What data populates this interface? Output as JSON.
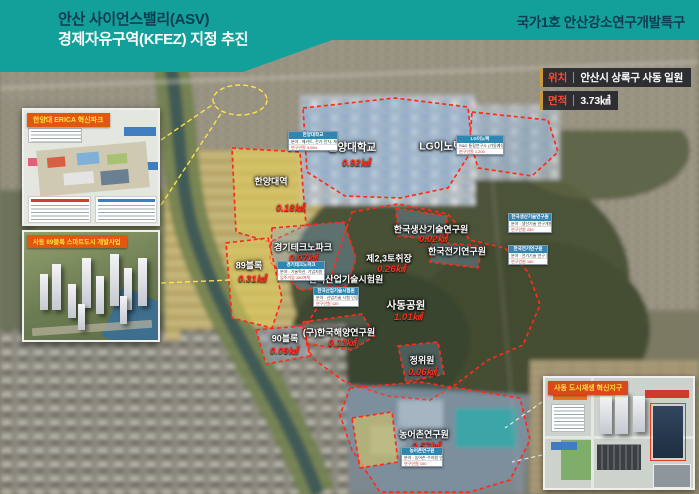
{
  "header": {
    "title_line1": "안산 사이언스밸리(ASV)",
    "title_line2": "경제자유구역(KFEZ) 지정 추진",
    "right_title": "국가1호 안산강소연구개발특구"
  },
  "info_box": {
    "rows": [
      {
        "label": "위치",
        "value": "안산시 상록구 사동 일원"
      },
      {
        "label": "면적",
        "value": "3.73㎢"
      }
    ]
  },
  "insets": [
    {
      "label": "한양대 ERICA 혁신파크"
    },
    {
      "label": "사동 89블록 스마트도시 개발사업"
    },
    {
      "label": "사동 도시재생 혁신지구"
    }
  ],
  "map": {
    "zones": [
      {
        "label": "한양대역",
        "area": "0.18㎢"
      },
      {
        "label": "한양대학교",
        "area": "0.92㎢"
      },
      {
        "label": "LG이노텍",
        "area": null
      },
      {
        "label": "경기테크노파크",
        "area": "0.07㎢"
      },
      {
        "label": "89블록",
        "area": "0.31㎢"
      },
      {
        "label": "한국산업기술시험원",
        "area": null
      },
      {
        "label": "제2,3토취장",
        "area": "0.26㎢"
      },
      {
        "label": "한국생산기술연구원",
        "area": "0.02㎢"
      },
      {
        "label": "한국전기연구원",
        "area": null
      },
      {
        "label": "사동공원",
        "area": "1.01㎢"
      },
      {
        "label": "(구)한국해양연구원",
        "area": "0.11㎢"
      },
      {
        "label": "정위원",
        "area": "0.06㎢"
      },
      {
        "label": "90블록",
        "area": "0.09㎢"
      },
      {
        "label": "농어촌연구원",
        "area": "0.57㎢"
      }
    ],
    "callouts": [
      {
        "title": "한양대학교",
        "line1": "분야 : 메카트, 전기·전자, 재료 등",
        "line2": "연구인원 3,084"
      },
      {
        "title": "LG이노텍",
        "line1": "R&D 통합연구소 (가동예정)",
        "line2": "연구인원 1,200"
      },
      {
        "title": "경기테크노파크",
        "line1": "분야 : 기술혁신, 기업지원 등",
        "line2": "입주기업 150여개"
      },
      {
        "title": "한국산업기술시험원",
        "line1": "분야 : 산업기술 시험·인증",
        "line2": "연구인원 120"
      },
      {
        "title": "한국생산기술연구원",
        "line1": "분야 : 생산기술 연구개발 등",
        "line2": "연구인원 230"
      },
      {
        "title": "한국전기연구원",
        "line1": "분야 : 전기기술 연구 등",
        "line2": "연구인원 150"
      },
      {
        "title": "농어촌연구원",
        "line1": "분야 : 농어촌·수자원 연구",
        "line2": "연구인원 100"
      }
    ]
  },
  "colors": {
    "header_bg": "#13a09b",
    "header_title_dark": "#0e3a52",
    "boundary_red": "#ff2b1a",
    "area_text_red": "#ff2f1e",
    "zone_blue_fill": "rgba(130,170,215,0.38)",
    "zone_yellow_fill": "rgba(230,208,88,0.5)",
    "inset_label_bg": "#e2570f",
    "inset_label_text": "#ffe33e",
    "info_label_red": "#ff4a2e"
  }
}
